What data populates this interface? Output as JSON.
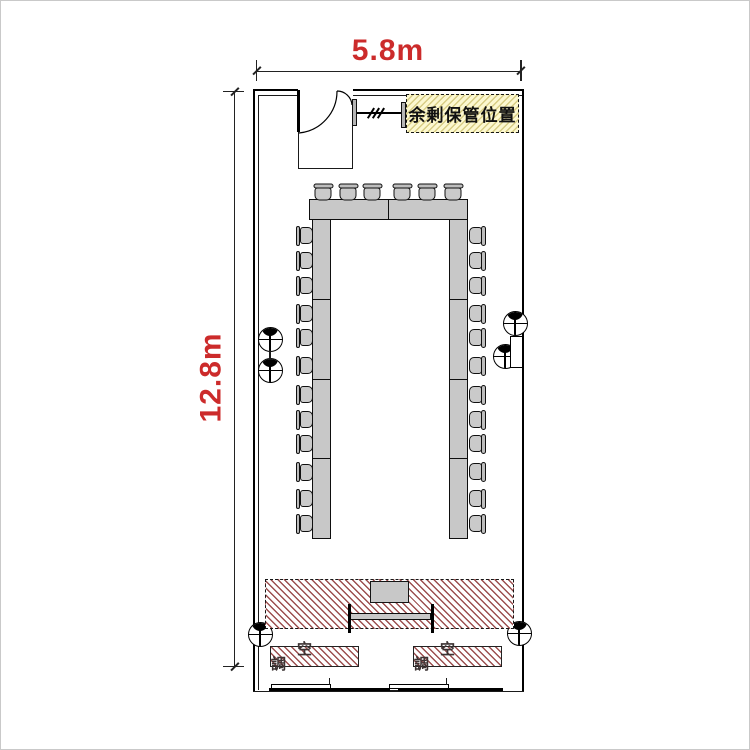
{
  "diagram": {
    "type": "meeting-room-floor-plan",
    "dimensions": {
      "width_label": "5.8m",
      "length_label": "12.8m",
      "text_color": "#cc2b2b"
    },
    "labels": {
      "storage": "余剰保管位置",
      "hvac_left": "空調",
      "hvac_right": "空調"
    },
    "colors": {
      "furniture_fill": "#c8c8c8",
      "hatch_stroke": "#9c4f4f",
      "storage_fill": "#fcf8d0",
      "storage_hatch": "#d8cd85",
      "wall_line": "#000000"
    },
    "furniture": {
      "layout": "U-shape",
      "seat_count": 30,
      "chairs": {
        "top": {
          "cy": 191,
          "cx": [
            322.5,
            347.5,
            371.5,
            401.5,
            426.5,
            452.5
          ]
        },
        "left": {
          "cx": 303,
          "cy": [
            234.5,
            259.5,
            284.5,
            312.5,
            336.5,
            364.5,
            393.5,
            418.5,
            442.5,
            471,
            497.5,
            522.5
          ]
        },
        "right": {
          "cx": 476,
          "cy": [
            234.5,
            259.5,
            284.5,
            312.5,
            336.5,
            364.5,
            393.5,
            418.5,
            442.5,
            471,
            497.5,
            522.5
          ]
        }
      },
      "tables": {
        "head": {
          "x": 308,
          "y": 198,
          "w": 159,
          "h": 20.5,
          "segments": 2
        },
        "left": {
          "x": 311,
          "y": 218,
          "w": 18.5,
          "h": 320,
          "segments": 4
        },
        "right": {
          "x": 448,
          "y": 218,
          "w": 18.5,
          "h": 320,
          "segments": 4
        }
      }
    },
    "wall_marks": [
      {
        "cx": 269,
        "cy": 338
      },
      {
        "cx": 269,
        "cy": 369
      },
      {
        "cx": 514,
        "cy": 322
      },
      {
        "cx": 504,
        "cy": 355
      },
      {
        "cx": 259,
        "cy": 633
      },
      {
        "cx": 518,
        "cy": 632
      }
    ]
  }
}
